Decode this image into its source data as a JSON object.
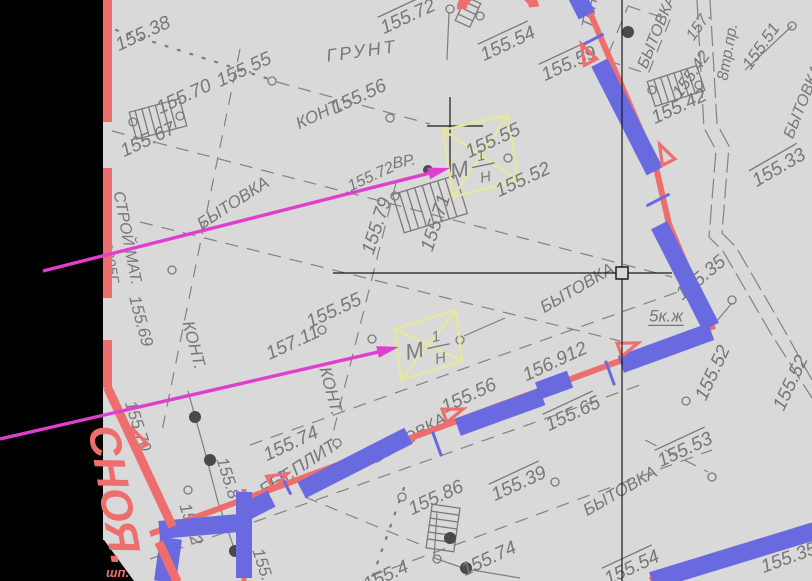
{
  "colors": {
    "red": "#ee6e6e",
    "blue": "#6a6ae0",
    "magenta": "#e03ece",
    "yellow": "#e8e89a",
    "gray_text": "#777777",
    "bg": "#d9d9d9",
    "black": "#000000"
  },
  "street": {
    "name": "СНОЯ.",
    "mark": "шп."
  },
  "benchmarks": [
    {
      "letter": "М",
      "num": "1",
      "den": "Н"
    },
    {
      "letter": "М",
      "num": "1",
      "den": "Н"
    }
  ],
  "labels": [
    {
      "t": "155.38",
      "x": 143,
      "y": 34,
      "r": -25,
      "s": 19,
      "ov": 0
    },
    {
      "t": "155.55",
      "x": 244,
      "y": 70,
      "r": -25,
      "s": 19,
      "ov": 0
    },
    {
      "t": "ГРУНТ",
      "x": 362,
      "y": 51,
      "r": -8,
      "s": 18,
      "ov": 0,
      "ls": 3
    },
    {
      "t": "155.56",
      "x": 359,
      "y": 97,
      "r": -25,
      "s": 19,
      "ov": 0
    },
    {
      "t": "КОНТ.",
      "x": 319,
      "y": 114,
      "r": -25,
      "s": 17,
      "ov": 0
    },
    {
      "t": "155.70",
      "x": 184,
      "y": 97,
      "r": -25,
      "s": 19,
      "ov": 0
    },
    {
      "t": "155.67",
      "x": 148,
      "y": 140,
      "r": -25,
      "s": 19,
      "ov": 0
    },
    {
      "t": "155.72",
      "x": 408,
      "y": 17,
      "r": -25,
      "s": 19,
      "ov": 1
    },
    {
      "t": "155.54",
      "x": 508,
      "y": 44,
      "r": -25,
      "s": 19,
      "ov": 1
    },
    {
      "t": "155.59",
      "x": 569,
      "y": 64,
      "r": -25,
      "s": 19,
      "ov": 1
    },
    {
      "t": "ТЕН",
      "x": 590,
      "y": 13,
      "r": -78,
      "s": 15,
      "ov": 0
    },
    {
      "t": "БЫТОВКА",
      "x": 657,
      "y": 32,
      "r": -68,
      "s": 16,
      "ov": 0
    },
    {
      "t": "157.",
      "x": 699,
      "y": 26,
      "r": -55,
      "s": 16,
      "ov": 0
    },
    {
      "t": "8тр.пр.",
      "x": 728,
      "y": 52,
      "r": -80,
      "s": 16,
      "ov": 0
    },
    {
      "t": "155.42",
      "x": 691,
      "y": 74,
      "r": -55,
      "s": 17,
      "ov": 0
    },
    {
      "t": "155.51",
      "x": 761,
      "y": 46,
      "r": -55,
      "s": 17,
      "ov": 0
    },
    {
      "t": "155.42",
      "x": 679,
      "y": 107,
      "r": -25,
      "s": 19,
      "ov": 0
    },
    {
      "t": "БЫТОВКА",
      "x": 803,
      "y": 102,
      "r": -68,
      "s": 16,
      "ov": 0
    },
    {
      "t": "155.33",
      "x": 779,
      "y": 168,
      "r": -30,
      "s": 19,
      "ov": 1
    },
    {
      "t": "155.55",
      "x": 493,
      "y": 141,
      "r": -25,
      "s": 19,
      "ov": 0
    },
    {
      "t": "155.52",
      "x": 523,
      "y": 180,
      "r": -25,
      "s": 19,
      "ov": 0
    },
    {
      "t": "ВР.",
      "x": 404,
      "y": 162,
      "r": -10,
      "s": 16,
      "ov": 0
    },
    {
      "t": "155.72",
      "x": 371,
      "y": 177,
      "r": -25,
      "s": 16,
      "ov": 0
    },
    {
      "t": "БЫТОВКА",
      "x": 233,
      "y": 203,
      "r": -33,
      "s": 17,
      "ov": 0
    },
    {
      "t": "155.79",
      "x": 377,
      "y": 226,
      "r": -72,
      "s": 19,
      "ov": 0
    },
    {
      "t": "155.71",
      "x": 436,
      "y": 223,
      "r": -72,
      "s": 19,
      "ov": 0
    },
    {
      "t": "СТРОЙ МАТ.",
      "x": 127,
      "y": 238,
      "r": 79,
      "s": 16,
      "ov": 0
    },
    {
      "t": "2005Г.",
      "x": 110,
      "y": 264,
      "r": 79,
      "s": 15,
      "ov": 0
    },
    {
      "t": "155.69",
      "x": 141,
      "y": 321,
      "r": 75,
      "s": 17,
      "ov": 0
    },
    {
      "t": "157.11",
      "x": 293,
      "y": 343,
      "r": -25,
      "s": 19,
      "ov": 0
    },
    {
      "t": "КОНТ.",
      "x": 194,
      "y": 345,
      "r": 75,
      "s": 17,
      "ov": 0
    },
    {
      "t": "155.55",
      "x": 334,
      "y": 311,
      "r": -25,
      "s": 19,
      "ov": 0
    },
    {
      "t": "156.912",
      "x": 555,
      "y": 362,
      "r": -25,
      "s": 19,
      "ov": 0
    },
    {
      "t": "155.56",
      "x": 469,
      "y": 396,
      "r": -25,
      "s": 19,
      "ov": 0
    },
    {
      "t": "БЫТОВКА",
      "x": 577,
      "y": 288,
      "r": -30,
      "s": 17,
      "ov": 0
    },
    {
      "t": "5к.ж",
      "x": 666,
      "y": 316,
      "r": 0,
      "s": 17,
      "ov": 0,
      "un": 1
    },
    {
      "t": "155.35",
      "x": 701,
      "y": 278,
      "r": -40,
      "s": 19,
      "ov": 0
    },
    {
      "t": "155.52",
      "x": 713,
      "y": 373,
      "r": -65,
      "s": 19,
      "ov": 0
    },
    {
      "t": "155.52",
      "x": 791,
      "y": 383,
      "r": -65,
      "s": 19,
      "ov": 0
    },
    {
      "t": "КОНТ.",
      "x": 331,
      "y": 391,
      "r": 75,
      "s": 17,
      "ov": 0
    },
    {
      "t": "155.74",
      "x": 291,
      "y": 444,
      "r": -25,
      "s": 19,
      "ov": 0
    },
    {
      "t": "БЫТОВКА",
      "x": 409,
      "y": 438,
      "r": -30,
      "s": 17,
      "ov": 0
    },
    {
      "t": "155.65",
      "x": 573,
      "y": 414,
      "r": -25,
      "s": 19,
      "ov": 1
    },
    {
      "t": "155.53",
      "x": 685,
      "y": 450,
      "r": -25,
      "s": 19,
      "ov": 1
    },
    {
      "t": "155.39",
      "x": 519,
      "y": 484,
      "r": -25,
      "s": 19,
      "ov": 1
    },
    {
      "t": "БЫТОВКА",
      "x": 620,
      "y": 491,
      "r": -30,
      "s": 17,
      "ov": 0
    },
    {
      "t": "БЕТ.ПЛИТ.",
      "x": 299,
      "y": 467,
      "r": -33,
      "s": 18,
      "ov": 0
    },
    {
      "t": "155.86",
      "x": 436,
      "y": 498,
      "r": -25,
      "s": 19,
      "ov": 0
    },
    {
      "t": "155.74",
      "x": 489,
      "y": 559,
      "r": -25,
      "s": 19,
      "ov": 0
    },
    {
      "t": "155.54",
      "x": 632,
      "y": 568,
      "r": -25,
      "s": 19,
      "ov": 1
    },
    {
      "t": "155.70",
      "x": 138,
      "y": 426,
      "r": 72,
      "s": 17,
      "ov": 0
    },
    {
      "t": "155.8",
      "x": 228,
      "y": 478,
      "r": 72,
      "s": 17,
      "ov": 0
    },
    {
      "t": "155.2",
      "x": 191,
      "y": 524,
      "r": 72,
      "s": 17,
      "ov": 0
    },
    {
      "t": "155.5",
      "x": 264,
      "y": 569,
      "r": 72,
      "s": 17,
      "ov": 0
    },
    {
      "t": "155.4",
      "x": 386,
      "y": 576,
      "r": -25,
      "s": 19,
      "ov": 0
    },
    {
      "t": "155.35",
      "x": 789,
      "y": 558,
      "r": -20,
      "s": 19,
      "ov": 0
    }
  ]
}
